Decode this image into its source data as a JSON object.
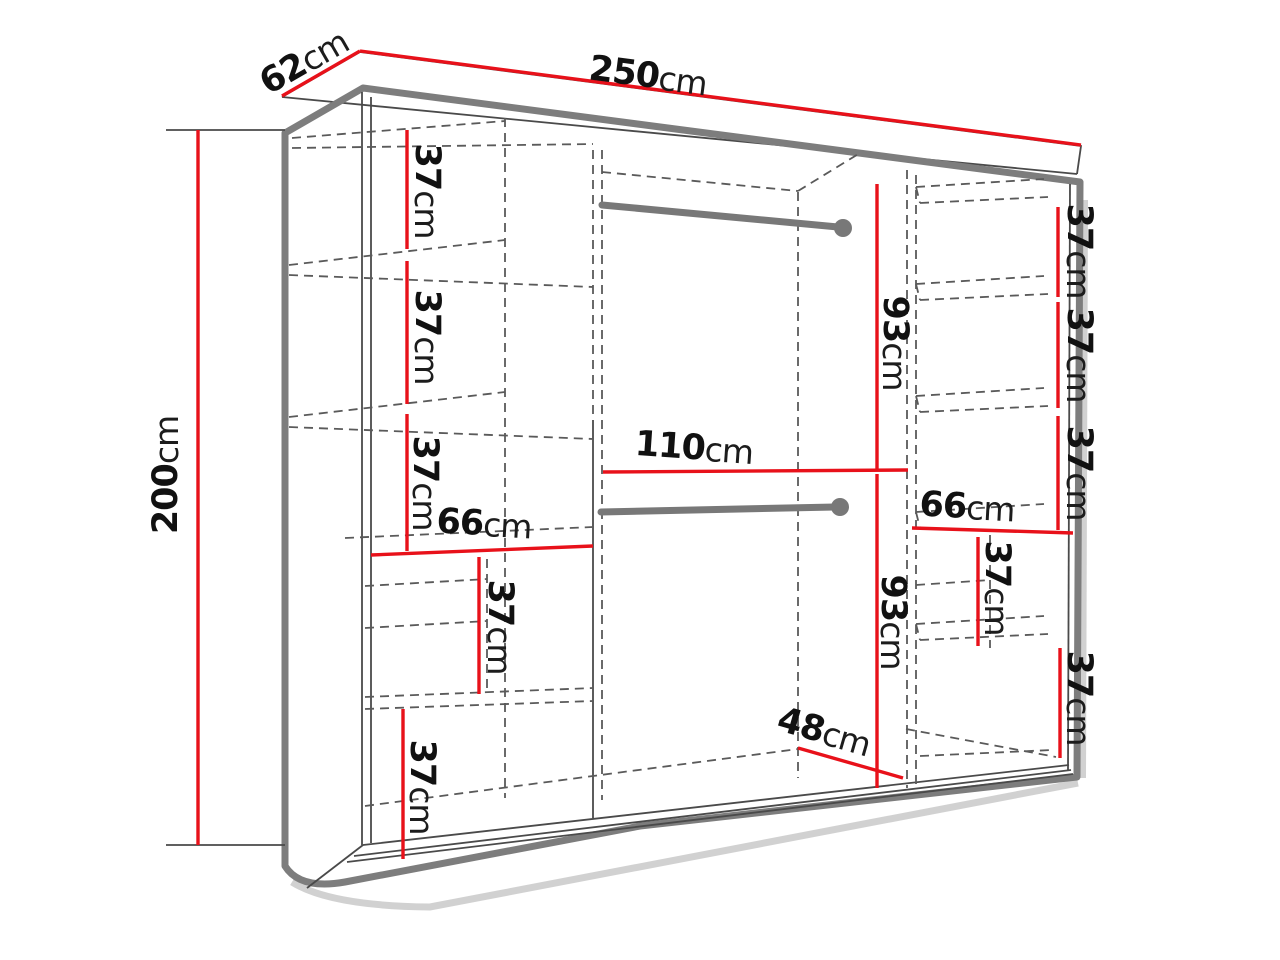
{
  "diagram": {
    "unit": "cm",
    "colors": {
      "dimension_line": "#e8111a",
      "drawing_outline": "#7d7d7d",
      "hidden_lines": "#5a5a5a",
      "background": "#ffffff"
    },
    "dims": [
      {
        "value": "250",
        "unit": "cm"
      },
      {
        "value": "62",
        "unit": "cm"
      },
      {
        "value": "200",
        "unit": "cm"
      },
      {
        "value": "37",
        "unit": "cm"
      },
      {
        "value": "37",
        "unit": "cm"
      },
      {
        "value": "37",
        "unit": "cm"
      },
      {
        "value": "66",
        "unit": "cm"
      },
      {
        "value": "37",
        "unit": "cm"
      },
      {
        "value": "37",
        "unit": "cm"
      },
      {
        "value": "110",
        "unit": "cm"
      },
      {
        "value": "93",
        "unit": "cm"
      },
      {
        "value": "93",
        "unit": "cm"
      },
      {
        "value": "48",
        "unit": "cm"
      },
      {
        "value": "37",
        "unit": "cm"
      },
      {
        "value": "37",
        "unit": "cm"
      },
      {
        "value": "37",
        "unit": "cm"
      },
      {
        "value": "66",
        "unit": "cm"
      },
      {
        "value": "37",
        "unit": "cm"
      },
      {
        "value": "37",
        "unit": "cm"
      }
    ]
  }
}
